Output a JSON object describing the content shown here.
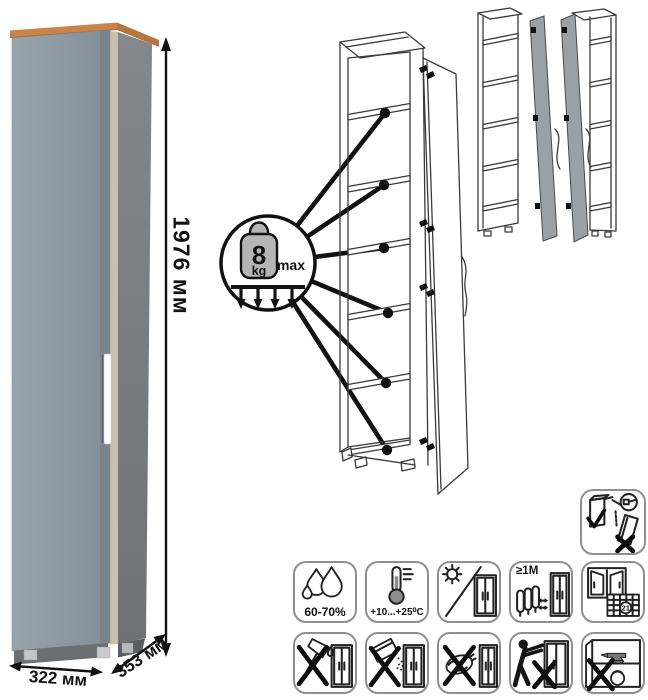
{
  "product": {
    "dimensions": {
      "height": "1976 мм",
      "width": "322 мм",
      "depth": "353 мм"
    }
  },
  "shelf_callout": {
    "weight": "8",
    "unit": "kg",
    "max": "max",
    "shelf_pointer_count": 6
  },
  "colors": {
    "wood_top": "#c8854a",
    "door_front": "#8e99a2",
    "side_panel": "#7b7f82",
    "edge_strip": "#cbbfad",
    "handle": "#ffffff",
    "variant_door": "#9aa0a3",
    "outline": "#3a3a3a",
    "icon_border": "#8f8f8f"
  },
  "care_icons": {
    "secure_to_wall": {
      "name": "secure-to-wall-icon"
    },
    "row1": [
      {
        "name": "humidity-icon",
        "label": "60-70%"
      },
      {
        "name": "temperature-icon",
        "label": "+10...+25⁰C"
      },
      {
        "name": "no-direct-sunlight-icon",
        "label": ""
      },
      {
        "name": "heat-source-distance-icon",
        "label": "≥1M"
      },
      {
        "name": "window-calendar-icon",
        "label": "21"
      }
    ],
    "row2": [
      {
        "name": "no-sharp-objects-icon",
        "label": ""
      },
      {
        "name": "no-abrasive-powder-icon",
        "label": ""
      },
      {
        "name": "no-wet-cleaning-icon",
        "label": ""
      },
      {
        "name": "no-dragging-icon",
        "label": ""
      },
      {
        "name": "no-heavy-load-icon",
        "label": ""
      }
    ]
  }
}
